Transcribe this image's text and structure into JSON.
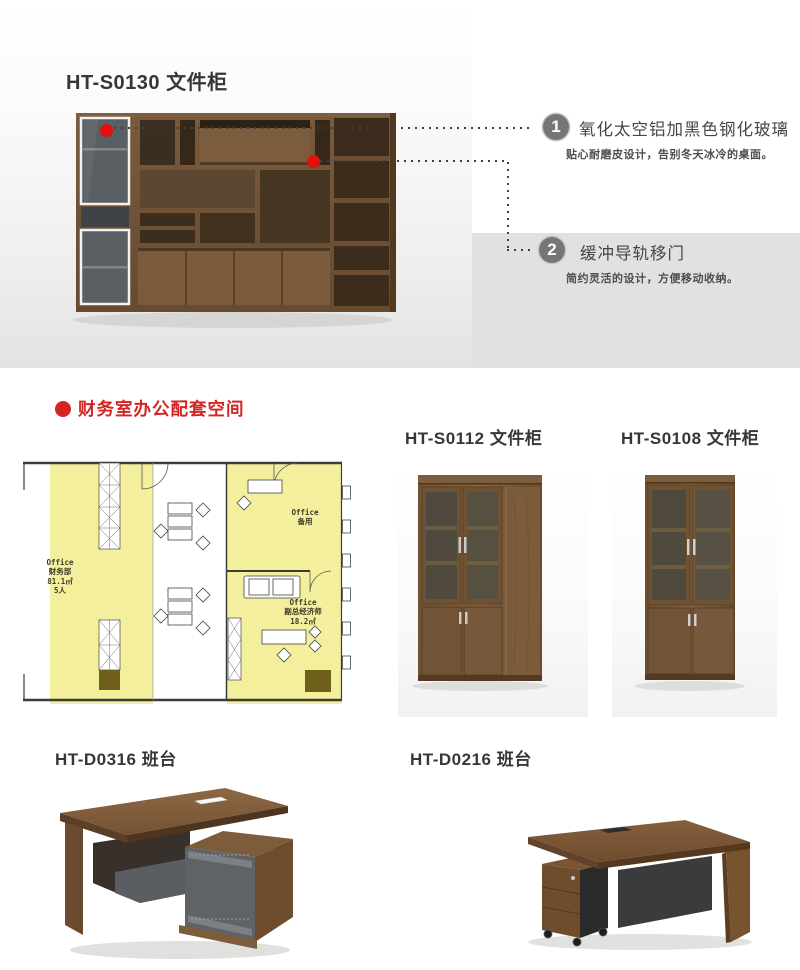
{
  "hero": {
    "title": "HT-S0130 文件柜",
    "callouts": [
      {
        "num": "1",
        "title": "氧化太空铝加黑色钢化玻璃",
        "desc": "贴心耐磨皮设计，告别冬天冰冷的桌面。"
      },
      {
        "num": "2",
        "title": "缓冲导轨移门",
        "desc": "简约灵活的设计，方便移动收纳。"
      }
    ]
  },
  "space_section": {
    "bullet": "",
    "heading": "财务室办公配套空间",
    "floor_plan_labels": {
      "finance_office": "Office\n财务部\n81.1㎡\n5人",
      "spare_office": "Office\n备用",
      "economist_office": "Office\n副总经济师\n18.2㎡"
    },
    "cabinets": [
      {
        "title": "HT-S0112 文件柜"
      },
      {
        "title": "HT-S0108 文件柜"
      }
    ]
  },
  "desk_section": {
    "desks": [
      {
        "title": "HT-D0316 班台"
      },
      {
        "title": "HT-D0216 班台"
      }
    ]
  },
  "colors": {
    "accent_red": "#d42522",
    "panel_gray": "#e1e1e0",
    "plan_yellow": "#f4ef9c",
    "hotspot_red": "#e2100e"
  }
}
